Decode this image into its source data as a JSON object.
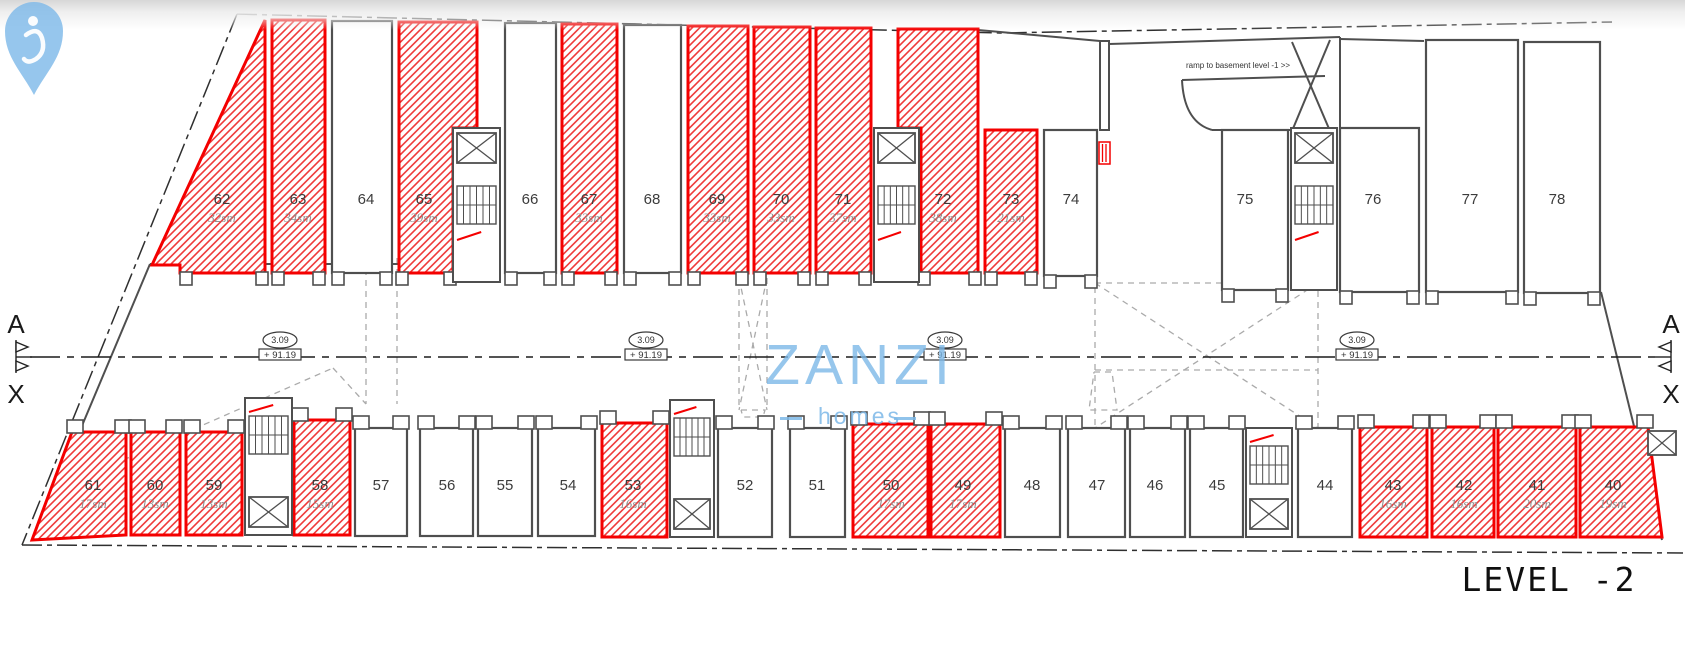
{
  "canvas": {
    "w": 1685,
    "h": 655
  },
  "colors": {
    "wall": "#4f4f4f",
    "red": "#f40000",
    "hatch": "#ef3b3b",
    "dash": "#aaaaaa",
    "text": "#3c3c3c",
    "sizetext": "#8f8f8f",
    "logo": "#7cb8e8",
    "line": "#2f2f2f"
  },
  "title": {
    "level_label": "LEVEL -2"
  },
  "ramp_note": "ramp to basement level -1 >>",
  "logo": {
    "brand": "ZANZI",
    "sub": "homes"
  },
  "elevation_marker": {
    "height": "3.09",
    "level": "+ 91.19",
    "xs": [
      280,
      646,
      945,
      1357
    ],
    "y": 340
  },
  "section_markers": [
    {
      "label_top": "A",
      "label_bottom": "X",
      "x": 16,
      "y": 357,
      "dir": 1
    },
    {
      "label_top": "A",
      "label_bottom": "X",
      "x": 1671,
      "y": 357,
      "dir": -1
    }
  ],
  "centerline": {
    "x1": 30,
    "x2": 1662,
    "y": 357
  },
  "boundary": [
    {
      "pts": [
        [
          237,
          14
        ],
        [
          1000,
          33
        ],
        [
          1612,
          22
        ]
      ]
    },
    {
      "pts": [
        [
          237,
          14
        ],
        [
          22,
          545
        ]
      ]
    },
    {
      "pts": [
        [
          22,
          545
        ],
        [
          1683,
          553
        ]
      ]
    }
  ],
  "walls": [
    [
      [
        150,
        264
      ],
      [
        60,
        478
      ]
    ],
    [
      [
        150,
        264
      ],
      [
        399,
        264
      ]
    ],
    [
      [
        1601,
        292
      ],
      [
        1662,
        540
      ]
    ],
    [
      [
        978,
        30
      ],
      [
        1100,
        41
      ]
    ],
    [
      [
        1109,
        44
      ],
      [
        1340,
        37
      ]
    ],
    [
      [
        1182,
        80
      ],
      [
        1325,
        76
      ]
    ],
    [
      [
        1212,
        130
      ],
      [
        1290,
        130
      ]
    ],
    [
      [
        1292,
        42
      ],
      [
        1330,
        131
      ]
    ],
    [
      [
        1330,
        40
      ],
      [
        1292,
        131
      ]
    ],
    [
      [
        1340,
        37
      ],
      [
        1340,
        127
      ]
    ],
    [
      [
        1340,
        39
      ],
      [
        1424,
        41
      ]
    ]
  ],
  "wall_rects": [
    [
      1100,
      41,
      9,
      89
    ]
  ],
  "red_rects": [
    [
      1099,
      142,
      11,
      22
    ]
  ],
  "right_elevator": {
    "x": 1648,
    "y": 431,
    "w": 28,
    "h": 24
  },
  "ramp_curve": "M1182,80 Q1184,122 1212,130",
  "dashed": [
    {
      "pts": [
        [
          366,
          258
        ],
        [
          366,
          404
        ]
      ]
    },
    {
      "pts": [
        [
          397,
          258
        ],
        [
          397,
          404
        ]
      ]
    },
    {
      "pts": [
        [
          73,
          482
        ],
        [
          333,
          368
        ]
      ]
    },
    {
      "pts": [
        [
          333,
          368
        ],
        [
          366,
          404
        ]
      ]
    },
    {
      "pts": [
        [
          739,
          278
        ],
        [
          739,
          410
        ]
      ]
    },
    {
      "pts": [
        [
          767,
          278
        ],
        [
          767,
          410
        ]
      ]
    },
    {
      "pts": [
        [
          739,
          278
        ],
        [
          767,
          410
        ]
      ]
    },
    {
      "pts": [
        [
          767,
          278
        ],
        [
          739,
          410
        ]
      ]
    },
    {
      "pts": [
        [
          741,
          410
        ],
        [
          765,
          410
        ],
        [
          763,
          417
        ],
        [
          743,
          417
        ],
        [
          741,
          410
        ]
      ]
    },
    {
      "pts": [
        [
          1094,
          372
        ],
        [
          1112,
          372
        ],
        [
          1117,
          410
        ],
        [
          1089,
          410
        ],
        [
          1094,
          372
        ]
      ]
    },
    {
      "pts": [
        [
          1095,
          283
        ],
        [
          1318,
          283
        ],
        [
          1318,
          428
        ],
        [
          1095,
          428
        ],
        [
          1095,
          283
        ]
      ]
    },
    {
      "pts": [
        [
          1095,
          283
        ],
        [
          1318,
          428
        ]
      ]
    },
    {
      "pts": [
        [
          1318,
          283
        ],
        [
          1095,
          428
        ]
      ]
    },
    {
      "pts": [
        [
          1095,
          370
        ],
        [
          1318,
          370
        ]
      ]
    }
  ],
  "stairwells": [
    {
      "x": 453,
      "y": 128,
      "w": 47,
      "h": 154,
      "type": "top"
    },
    {
      "x": 874,
      "y": 128,
      "w": 45,
      "h": 154,
      "type": "top"
    },
    {
      "x": 1291,
      "y": 128,
      "w": 46,
      "h": 162,
      "type": "top"
    },
    {
      "x": 245,
      "y": 398,
      "w": 47,
      "h": 137,
      "type": "bottom"
    },
    {
      "x": 670,
      "y": 400,
      "w": 44,
      "h": 137,
      "type": "bottom"
    },
    {
      "x": 1246,
      "y": 428,
      "w": 46,
      "h": 109,
      "type": "bottom"
    }
  ],
  "units": [
    {
      "id": "62",
      "size": "32sm",
      "hatched": true,
      "row": "top",
      "poly": [
        [
          265,
          20
        ],
        [
          265,
          273
        ],
        [
          180,
          273
        ],
        [
          180,
          265
        ],
        [
          152,
          265
        ]
      ],
      "label": [
        222,
        204
      ],
      "tabxs": [
        186,
        262
      ],
      "taby": 273
    },
    {
      "id": "63",
      "size": "34sm",
      "hatched": true,
      "row": "top",
      "rect": [
        272,
        20,
        325,
        273
      ],
      "label": [
        298,
        204
      ]
    },
    {
      "id": "64",
      "size": "",
      "hatched": false,
      "row": "top",
      "rect": [
        332,
        21,
        392,
        273
      ],
      "label": [
        366,
        204
      ]
    },
    {
      "id": "65",
      "size": "39sm",
      "hatched": true,
      "row": "top",
      "poly": [
        [
          399,
          22
        ],
        [
          477,
          22
        ],
        [
          477,
          128
        ],
        [
          453,
          128
        ],
        [
          453,
          273
        ],
        [
          399,
          273
        ]
      ],
      "label": [
        424,
        204
      ],
      "tabxs": [
        402,
        450
      ],
      "taby": 273
    },
    {
      "id": "66",
      "size": "",
      "hatched": false,
      "row": "top",
      "rect": [
        505,
        23,
        556,
        273
      ],
      "label": [
        530,
        204
      ]
    },
    {
      "id": "67",
      "size": "33sm",
      "hatched": true,
      "row": "top",
      "rect": [
        562,
        24,
        617,
        273
      ],
      "label": [
        589,
        204
      ]
    },
    {
      "id": "68",
      "size": "",
      "hatched": false,
      "row": "top",
      "rect": [
        624,
        25,
        681,
        273
      ],
      "label": [
        652,
        204
      ]
    },
    {
      "id": "69",
      "size": "33sm",
      "hatched": true,
      "row": "top",
      "rect": [
        688,
        26,
        748,
        273
      ],
      "label": [
        717,
        204
      ]
    },
    {
      "id": "70",
      "size": "33sm",
      "hatched": true,
      "row": "top",
      "rect": [
        754,
        27,
        810,
        273
      ],
      "label": [
        781,
        204
      ]
    },
    {
      "id": "71",
      "size": "37sm",
      "hatched": true,
      "row": "top",
      "rect": [
        816,
        28,
        871,
        273
      ],
      "label": [
        843,
        204
      ]
    },
    {
      "id": "72",
      "size": "38sm",
      "hatched": true,
      "row": "top",
      "poly": [
        [
          898,
          29
        ],
        [
          978,
          29
        ],
        [
          978,
          273
        ],
        [
          921,
          273
        ],
        [
          921,
          128
        ],
        [
          898,
          128
        ]
      ],
      "label": [
        943,
        204
      ],
      "tabxs": [
        924,
        975
      ],
      "taby": 273
    },
    {
      "id": "73",
      "size": "21sm",
      "hatched": true,
      "row": "top",
      "rect": [
        985,
        130,
        1037,
        273
      ],
      "label": [
        1011,
        204
      ]
    },
    {
      "id": "74",
      "size": "",
      "hatched": false,
      "row": "top",
      "rect": [
        1044,
        130,
        1097,
        276
      ],
      "label": [
        1071,
        204
      ]
    },
    {
      "id": "75",
      "size": "",
      "hatched": false,
      "row": "top",
      "rect": [
        1222,
        130,
        1288,
        290
      ],
      "label": [
        1245,
        204
      ]
    },
    {
      "id": "76",
      "size": "",
      "hatched": false,
      "row": "top",
      "rect": [
        1340,
        128,
        1419,
        292
      ],
      "label": [
        1373,
        204
      ]
    },
    {
      "id": "77",
      "size": "",
      "hatched": false,
      "row": "top",
      "rect": [
        1426,
        40,
        1518,
        292
      ],
      "label": [
        1470,
        204
      ]
    },
    {
      "id": "78",
      "size": "",
      "hatched": false,
      "row": "top",
      "rect": [
        1524,
        42,
        1600,
        293
      ],
      "label": [
        1557,
        204
      ]
    },
    {
      "id": "61",
      "size": "17sm",
      "hatched": true,
      "row": "bottom",
      "poly": [
        [
          72,
          432
        ],
        [
          126,
          432
        ],
        [
          126,
          535
        ],
        [
          32,
          540
        ]
      ],
      "label": [
        93,
        490
      ],
      "tabxs": [
        75,
        123
      ],
      "taby": 432
    },
    {
      "id": "60",
      "size": "13sm",
      "hatched": true,
      "row": "bottom",
      "rect": [
        131,
        432,
        180,
        535
      ],
      "label": [
        155,
        490
      ]
    },
    {
      "id": "59",
      "size": "13sm",
      "hatched": true,
      "row": "bottom",
      "rect": [
        186,
        432,
        242,
        535
      ],
      "label": [
        214,
        490
      ]
    },
    {
      "id": "58",
      "size": "15sm",
      "hatched": true,
      "row": "bottom",
      "rect": [
        294,
        420,
        350,
        535
      ],
      "label": [
        320,
        490
      ]
    },
    {
      "id": "57",
      "size": "",
      "hatched": false,
      "row": "bottom",
      "rect": [
        355,
        428,
        407,
        536
      ],
      "label": [
        381,
        490
      ]
    },
    {
      "id": "56",
      "size": "",
      "hatched": false,
      "row": "bottom",
      "rect": [
        420,
        428,
        473,
        536
      ],
      "label": [
        447,
        490
      ]
    },
    {
      "id": "55",
      "size": "",
      "hatched": false,
      "row": "bottom",
      "rect": [
        478,
        428,
        532,
        536
      ],
      "label": [
        505,
        490
      ]
    },
    {
      "id": "54",
      "size": "",
      "hatched": false,
      "row": "bottom",
      "rect": [
        538,
        428,
        595,
        536
      ],
      "label": [
        568,
        490
      ]
    },
    {
      "id": "53",
      "size": "16sm",
      "hatched": true,
      "row": "bottom",
      "rect": [
        602,
        423,
        667,
        537
      ],
      "label": [
        633,
        490
      ]
    },
    {
      "id": "52",
      "size": "",
      "hatched": false,
      "row": "bottom",
      "rect": [
        718,
        428,
        772,
        537
      ],
      "label": [
        745,
        490
      ]
    },
    {
      "id": "51",
      "size": "",
      "hatched": false,
      "row": "bottom",
      "rect": [
        790,
        428,
        845,
        537
      ],
      "label": [
        817,
        490
      ]
    },
    {
      "id": "50",
      "size": "17sm",
      "hatched": true,
      "row": "bottom",
      "rect": [
        853,
        424,
        928,
        537
      ],
      "label": [
        891,
        490
      ]
    },
    {
      "id": "49",
      "size": "17sm",
      "hatched": true,
      "row": "bottom",
      "rect": [
        931,
        424,
        1000,
        537
      ],
      "label": [
        963,
        490
      ]
    },
    {
      "id": "48",
      "size": "",
      "hatched": false,
      "row": "bottom",
      "rect": [
        1005,
        428,
        1060,
        537
      ],
      "label": [
        1032,
        490
      ]
    },
    {
      "id": "47",
      "size": "",
      "hatched": false,
      "row": "bottom",
      "rect": [
        1068,
        428,
        1125,
        537
      ],
      "label": [
        1097,
        490
      ]
    },
    {
      "id": "46",
      "size": "",
      "hatched": false,
      "row": "bottom",
      "rect": [
        1130,
        428,
        1185,
        537
      ],
      "label": [
        1155,
        490
      ]
    },
    {
      "id": "45",
      "size": "",
      "hatched": false,
      "row": "bottom",
      "rect": [
        1190,
        428,
        1243,
        537
      ],
      "label": [
        1217,
        490
      ]
    },
    {
      "id": "44",
      "size": "",
      "hatched": false,
      "row": "bottom",
      "rect": [
        1298,
        428,
        1352,
        537
      ],
      "label": [
        1325,
        490
      ]
    },
    {
      "id": "43",
      "size": "16sm",
      "hatched": true,
      "row": "bottom",
      "rect": [
        1360,
        427,
        1427,
        537
      ],
      "label": [
        1393,
        490
      ]
    },
    {
      "id": "42",
      "size": "16sm",
      "hatched": true,
      "row": "bottom",
      "rect": [
        1432,
        427,
        1494,
        537
      ],
      "label": [
        1464,
        490
      ]
    },
    {
      "id": "41",
      "size": "20sm",
      "hatched": true,
      "row": "bottom",
      "rect": [
        1498,
        427,
        1576,
        537
      ],
      "label": [
        1537,
        490
      ]
    },
    {
      "id": "40",
      "size": "19sm",
      "hatched": true,
      "row": "bottom",
      "poly": [
        [
          1580,
          427
        ],
        [
          1648,
          427
        ],
        [
          1662,
          537
        ],
        [
          1580,
          537
        ]
      ],
      "label": [
        1613,
        490
      ],
      "tabxs": [
        1583,
        1645
      ],
      "taby": 427
    }
  ]
}
